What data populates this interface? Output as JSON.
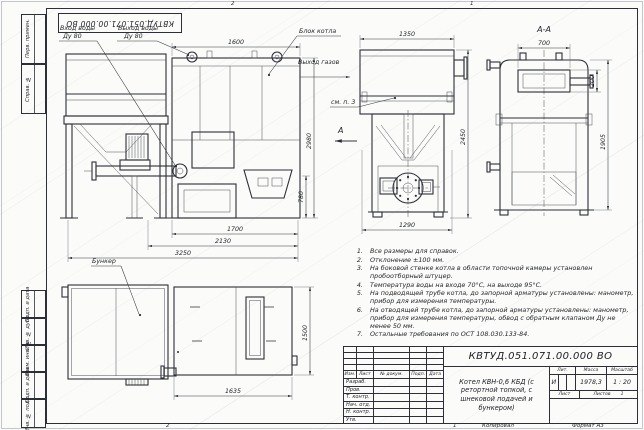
{
  "sheet": {
    "stamp_top_rotated": "КВТУД.051.071.00.000 ВО",
    "zones": {
      "top_left": "2",
      "top_right": "1",
      "bottom_left": "2",
      "bottom_right": "1"
    }
  },
  "margin_labels": [
    "Перв. примен.",
    "Справ. №",
    "Подп. и дата",
    "Инв. № дубл.",
    "Взам. инв. №",
    "Подп. и дата",
    "Инв. № подл."
  ],
  "callouts": {
    "water_in_line1": "Вход воды",
    "water_in_line2": "Ду 80",
    "water_out_line1": "Выход воды",
    "water_out_line2": "Ду 80",
    "boiler_block": "Блок котла",
    "gas_out": "Выход газов",
    "see_item3": "см. п. 3",
    "section_arrow": "А",
    "section_view_title": "А-А",
    "bunker": "Бункер"
  },
  "dimensions": {
    "boiler_top_width": "1600",
    "boiler_height": "2980",
    "feeder_axis_height": "780",
    "boiler_base": "1700",
    "base_mid": "2130",
    "overall_length": "3250",
    "front_top_width": "1350",
    "front_height": "2450",
    "front_base_width": "1290",
    "section_door_width": "700",
    "section_door_height": "200",
    "section_height": "1905",
    "plan_length": "1635",
    "plan_width": "1500"
  },
  "notes": [
    "Все размеры для справок.",
    "Отклонение ±100 мм.",
    "На боковой стенке котла в области топочной камеры установлен пробоотборный штуцер.",
    "Температура воды на входе 70°С, на выходе 95°С.",
    "На подводящей трубе котла, до запорной арматуры установлены: манометр, прибор для измерения температуры.",
    "На отводящей трубе котла, до запорной арматуры установлены: манометр, прибор для измерения температуры, обвод с обратным клапаном Ду не менее 50 мм.",
    "Остальные требования по ОСТ 108.030.133-84."
  ],
  "title_block": {
    "doc_number": "КВТУД.051.071.00.000 ВО",
    "product_title": "Котел КВН-0,6 КБД (с ретортной топкой, с шнековой подачей и бункером)",
    "header_cols": [
      "Изм.",
      "Лист",
      "№ докум.",
      "Подп.",
      "Дата"
    ],
    "role_rows": [
      "Разраб.",
      "Пров.",
      "Т. контр.",
      "Нач. отд.",
      "Н. контр.",
      "Утв."
    ],
    "lit_label": "Лит.",
    "lit_value": "И",
    "mass_label": "Масса",
    "mass_value": "1978,3",
    "scale_label": "Масштаб",
    "scale_value": "1 : 20",
    "sheet_label": "Лист",
    "sheets_label": "Листов",
    "sheets_value": "1",
    "copied_label": "Копировал",
    "format_label": "Формат А3"
  }
}
